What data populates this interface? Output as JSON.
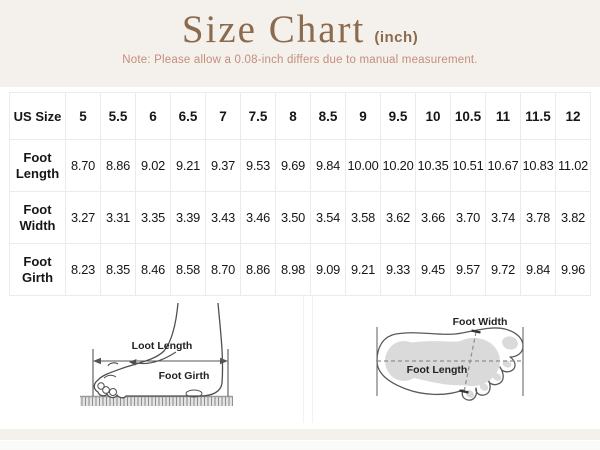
{
  "header": {
    "title": "Size Chart",
    "unit": "(inch)",
    "note": "Note: Please allow a 0.08-inch differs due to manual measurement."
  },
  "table": {
    "corner_label": "US Size",
    "sizes": [
      "5",
      "5.5",
      "6",
      "6.5",
      "7",
      "7.5",
      "8",
      "8.5",
      "9",
      "9.5",
      "10",
      "10.5",
      "11",
      "11.5",
      "12"
    ],
    "rows": [
      {
        "label": "Foot Length",
        "values": [
          "8.70",
          "8.86",
          "9.02",
          "9.21",
          "9.37",
          "9.53",
          "9.69",
          "9.84",
          "10.00",
          "10.20",
          "10.35",
          "10.51",
          "10.67",
          "10.83",
          "11.02"
        ]
      },
      {
        "label": "Foot Width",
        "values": [
          "3.27",
          "3.31",
          "3.35",
          "3.39",
          "3.43",
          "3.46",
          "3.50",
          "3.54",
          "3.58",
          "3.62",
          "3.66",
          "3.70",
          "3.74",
          "3.78",
          "3.82"
        ]
      },
      {
        "label": "Foot Girth",
        "values": [
          "8.23",
          "8.35",
          "8.46",
          "8.58",
          "8.70",
          "8.86",
          "8.98",
          "9.09",
          "9.21",
          "9.33",
          "9.45",
          "9.57",
          "9.72",
          "9.84",
          "9.96"
        ]
      }
    ]
  },
  "diagrams": {
    "side_view": {
      "length_label": "Loot Length",
      "girth_label": "Foot Girth"
    },
    "top_view": {
      "width_label": "Foot Width",
      "length_label": "Foot Length"
    }
  },
  "colors": {
    "title_brown": "#8b6a4e",
    "note_rose": "#c48d7b",
    "page_beige": "#f4f1ec",
    "grid_line": "#eaeaf0",
    "footprint_gray": "#dadada",
    "sketch_stroke": "#4f4f4f"
  }
}
